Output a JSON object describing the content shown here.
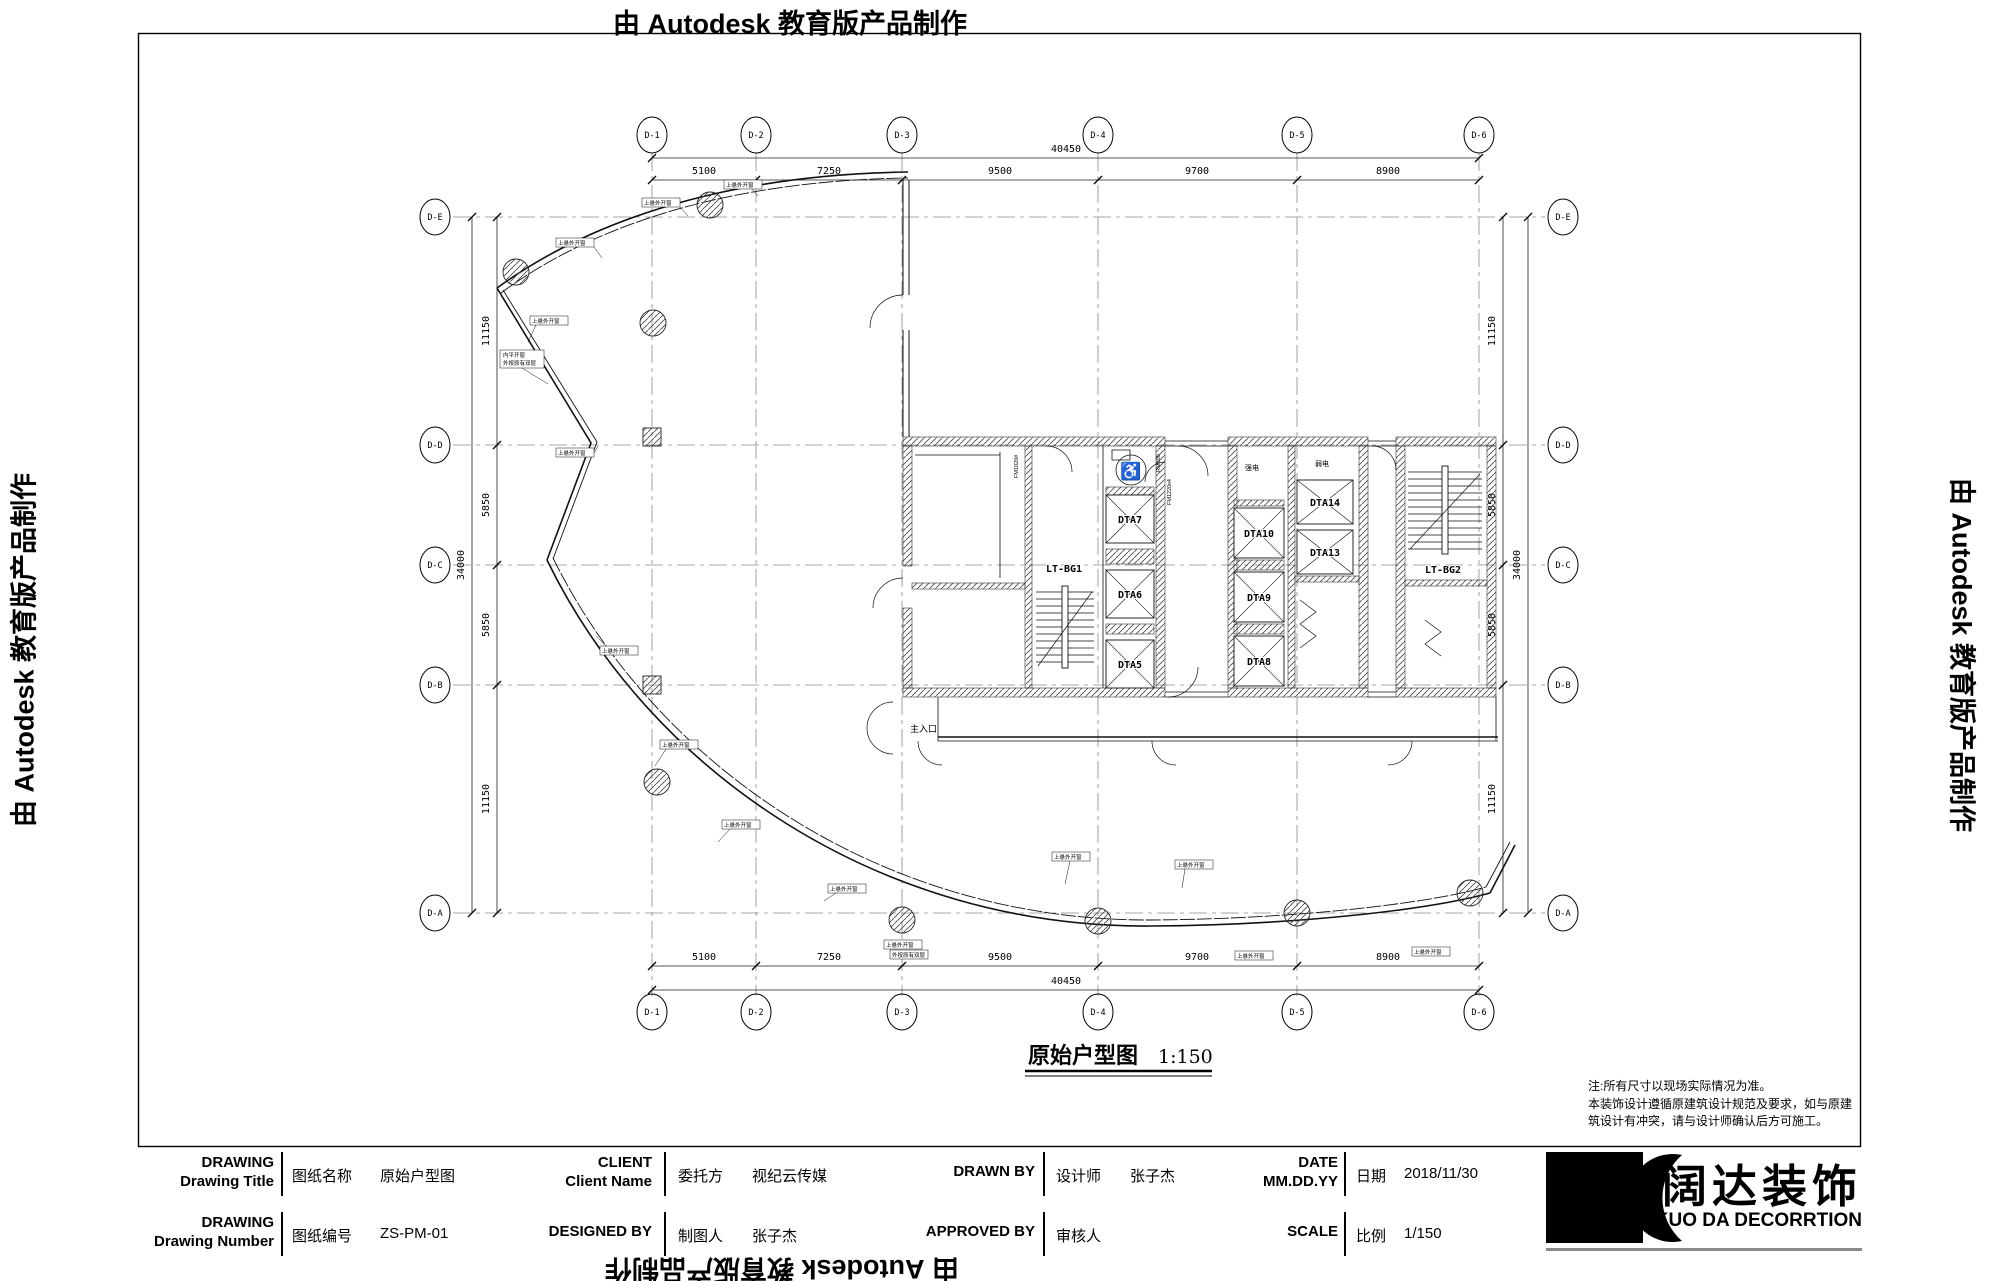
{
  "watermark": {
    "text": "由 Autodesk 教育版产品制作"
  },
  "sheet": {
    "plan_title": "原始户型图",
    "plan_scale": "1:150",
    "notes_line1": "注:所有尺寸以现场实际情况为准。",
    "notes_line2": "本装饰设计遵循原建筑设计规范及要求，如与原建",
    "notes_line3": "筑设计有冲突，请与设计师确认后方可施工。"
  },
  "grid": {
    "cols": [
      "D-1",
      "D-2",
      "D-3",
      "D-4",
      "D-5",
      "D-6"
    ],
    "rows": [
      "D-E",
      "D-D",
      "D-C",
      "D-B",
      "D-A"
    ],
    "col_dims": [
      "5100",
      "7250",
      "9500",
      "9700",
      "8900"
    ],
    "col_total": "40450",
    "row_dims": [
      "11150",
      "5850",
      "5850",
      "11150"
    ],
    "row_total": "34000"
  },
  "plan": {
    "stair1": "LT-BG1",
    "stair2": "LT-BG2",
    "lifts": {
      "dta5": "DTA5",
      "dta6": "DTA6",
      "dta7": "DTA7",
      "dta8": "DTA8",
      "dta9": "DTA9",
      "dta10": "DTA10",
      "dta13": "DTA13",
      "dta14": "DTA14"
    },
    "room_strong_elec": "强电",
    "room_weak_elec": "弱电",
    "entrance": "主入口",
    "win_label": "上悬外开窗",
    "win_label2a": "内平开窗",
    "win_label2b": "外按原有双层",
    "door1": "FM1020#",
    "door2": "FM1220s4",
    "door3": "RM800",
    "wc_icon": "♿"
  },
  "titleblock": {
    "r1c1_en1": "DRAWING",
    "r1c1_en2": "Drawing Title",
    "r1c1_cn": "图纸名称",
    "r1c1_val": "原始户型图",
    "r1c2_en1": "CLIENT",
    "r1c2_en2": "Client Name",
    "r1c2_cn": "委托方",
    "r1c2_val": "视纪云传媒",
    "r1c3_en1": "DRAWN  BY",
    "r1c3_cn": "设计师",
    "r1c3_val": "张子杰",
    "r1c4_en1": "DATE",
    "r1c4_en2": "MM.DD.YY",
    "r1c4_cn": "日期",
    "r1c4_val": "2018/11/30",
    "r2c1_en1": "DRAWING",
    "r2c1_en2": "Drawing Number",
    "r2c1_cn": "图纸编号",
    "r2c1_val": "ZS-PM-01",
    "r2c2_en1": "DESIGNED BY",
    "r2c2_cn": "制图人",
    "r2c2_val": "张子杰",
    "r2c3_en1": "APPROVED BY",
    "r2c3_cn": "审核人",
    "r2c3_val": "",
    "r2c4_en1": "SCALE",
    "r2c4_cn": "比例",
    "r2c4_val": "1/150"
  },
  "logo": {
    "cn": "阔达装饰",
    "en": "KUO DA DECORRTION"
  }
}
